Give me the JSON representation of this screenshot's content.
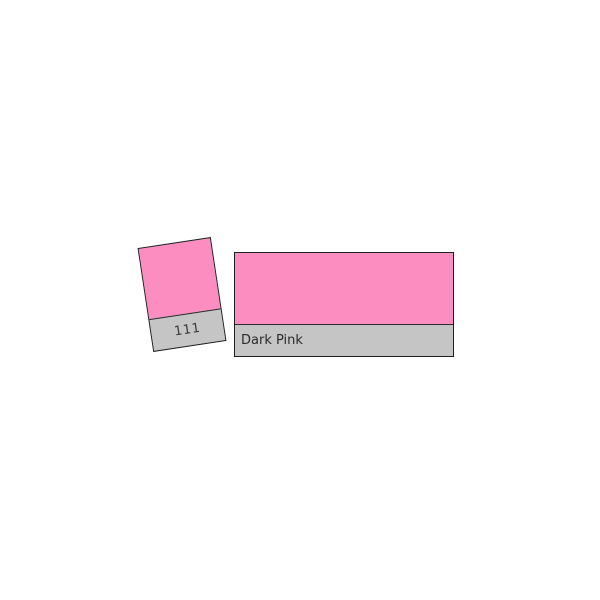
{
  "swatch": {
    "code": "111",
    "name": "Dark Pink",
    "colors": {
      "pink": "#FC8DC1",
      "label_gray": "#C5C5C5",
      "border": "#1F1F1F",
      "divider": "#2A2A2A",
      "code_text": "#3A3A3A",
      "name_text": "#2B2B2B",
      "background": "#FFFFFF"
    }
  }
}
